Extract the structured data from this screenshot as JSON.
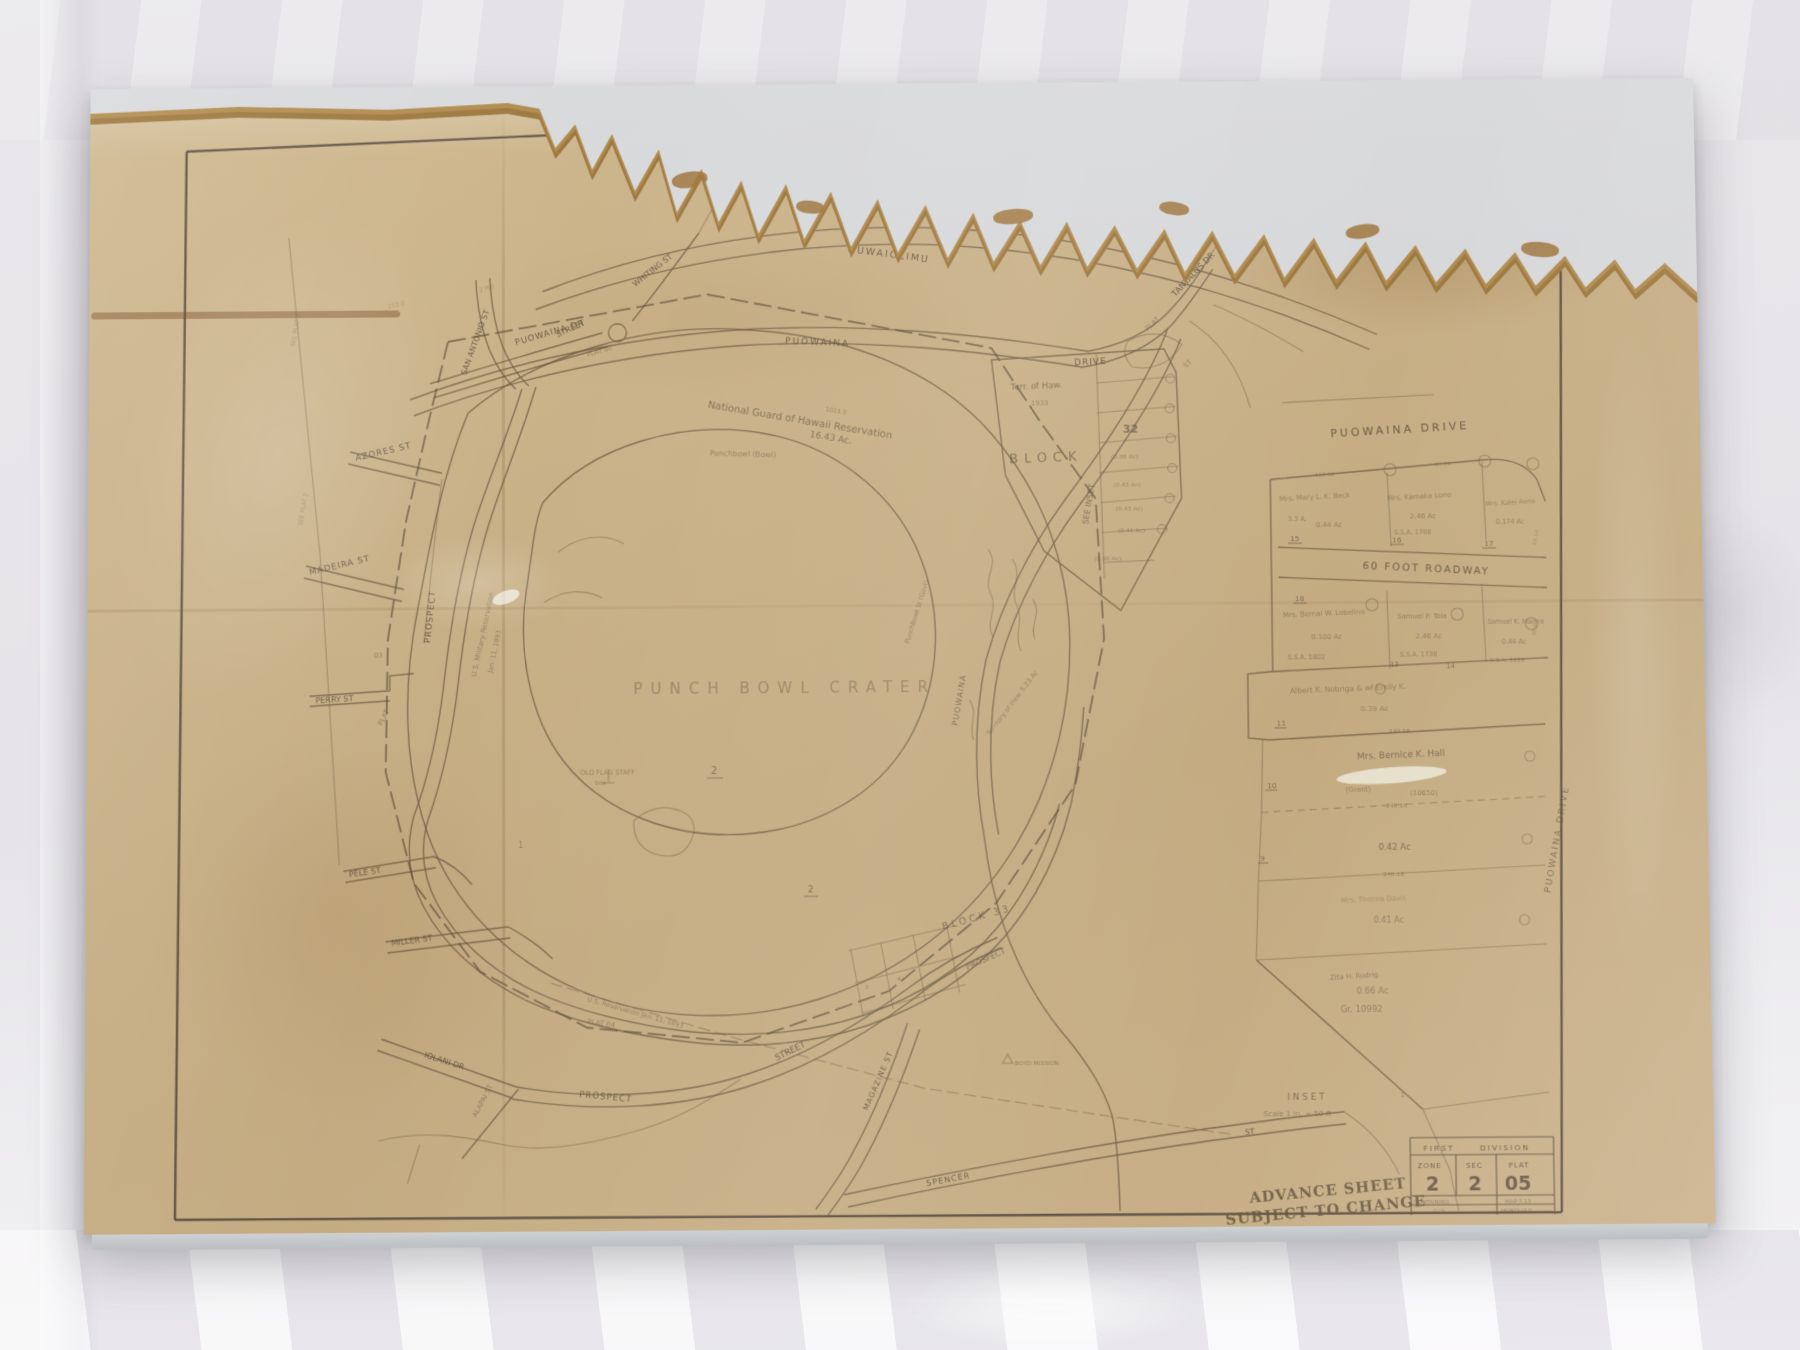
{
  "colors": {
    "paper": "#c9b188",
    "paper_torn_edge": "#9d7940",
    "ink": "#57483a",
    "sleeve_backing": "#d6d7d9",
    "fabric": "#e9e7ea",
    "stamp_ink": "#66563f"
  },
  "map": {
    "streets": {
      "auwaiolimu": "AUWAIOLIMU",
      "whiting": "WHITING ST",
      "puowaina_dr": "PUOWAINA DR",
      "street_upper": "STREET",
      "plat06": "PLAT 06",
      "puowaina": "PUOWAINA",
      "drive": "DRIVE",
      "plat07": "PLAT",
      "tantalus_st": "ST",
      "tantalus": "TANTALUS DR",
      "san_antonio": "SAN ANTONIO ST",
      "azores": "AZORES ST",
      "madeira": "MADEIRA ST",
      "prospect_west": "PROSPECT",
      "perry": "PERRY ST",
      "plat03": "PLAT",
      "plat03_num": "03",
      "pele": "PELE ST",
      "miller": "MILLER ST",
      "iolani": "IOLANI DR",
      "alapai": "ALAPAI ST",
      "prospect_south": "PROSPECT",
      "street_south": "STREET",
      "prospect_east": "PROSPECT",
      "plat04": "PLAT 04",
      "magazine": "MAGAZINE ST",
      "spencer": "SPENCER",
      "spencer_st2": "ST",
      "puowaina_east": "PUOWAINA"
    },
    "labels": {
      "crater": "PUNCH BOWL CRATER",
      "ng1": "National Guard of Hawaii Reservation",
      "ng2": "16.43 Ac.",
      "meas1": "1023.9",
      "punchbowl_bowl": "Punchbowl (Bowl)",
      "usmil1": "U.S. Military Reservation",
      "usmil2": "Jan. 11, 1893",
      "usres": "U.S. Reservation  Jan. 11, 1893",
      "terr1": "Terr. of Haw.",
      "terr2": "1933",
      "block": "BLOCK",
      "block32": "32",
      "see_inset": "SEE INSET",
      "block33": "BLOCK 33",
      "flag1": "OLD FLAG STAFF",
      "flag2": "Site",
      "n1": "1",
      "n2": "2",
      "n2b": "2",
      "n3": "3",
      "n4": "4",
      "boyd": "BOYD MISSION",
      "punchbowl_st": "Punchbowl St (Govt)",
      "territory": "Territory of Haw.  5.23 Ac",
      "ac1": "(0.38 Ac)",
      "ac2": "(0.43 Ac)",
      "ac3": "(0.43 Ac)",
      "ac4": "(0.41 Ac)",
      "ac5": "(0.90 Ac)",
      "see_plat_l1": "SEE PLAT 2",
      "see_plat_l2": "SEE PLAT 2",
      "meas2": "2760",
      "meas3": "212.0"
    }
  },
  "inset": {
    "header": "PUOWAINA DRIVE",
    "roadway": "60 FOOT ROADWAY",
    "drive_vertical": "PUOWAINA  DRIVE",
    "inset_l1": "INSET",
    "inset_l2": "Scale 1 in. = 50 ft",
    "p15": {
      "num": "15",
      "name": "Mrs. Mary L. K. Beck",
      "l2": "3.3 A.",
      "l3": "0.44 Ac"
    },
    "p16": {
      "num": "16",
      "name": "Mrs. Kamaka Lono",
      "l2": "2.46 Ac",
      "l3": "S.S.A. 1788"
    },
    "p17": {
      "num": "17",
      "name": "Mrs. Kalei Aona",
      "l2": "0.174 Ac"
    },
    "p18": {
      "num": "18",
      "name": "Mrs. Bernal W. Lobelino",
      "l2": "0.100 Ac",
      "l3": "S.S.A. 1802"
    },
    "p13": {
      "num": "13",
      "name": "Samuel P. Tola",
      "l2": "2.46 Ac",
      "l3": "S.S.A. 1738"
    },
    "p14": {
      "num": "14",
      "name": "Samuel K. Mamia",
      "l2": "0.44 Ac",
      "l3": "S.S.A. 1139"
    },
    "p11": {
      "num": "11",
      "name": "Albert K. Nobriga & wf Emily K.",
      "l2": "0.39 Ac",
      "meas": "240.18"
    },
    "p10": {
      "num": "10",
      "name": "Mrs. Bernice K. Hall",
      "l2": "(Grant)",
      "l3": "(10650)",
      "meas": "240.18"
    },
    "p9": {
      "num": "9",
      "l2": "0.42 Ac",
      "meas": "240.18"
    },
    "p8": {
      "name": "Mrs. Thelma Davis",
      "l2": "0.41 Ac"
    },
    "tri": {
      "name": "Zita H. Rodrig.",
      "l2": "0.66 Ac",
      "l3": "Gr. 10992",
      "n": "1"
    },
    "meas_a": "122.18",
    "meas_b": "87.64",
    "meas_c": "66.14",
    "meas_d": "98.6"
  },
  "title_block": {
    "div1": "FIRST",
    "div2": "DIVISION",
    "zone_h": "ZONE",
    "sec_h": "SEC",
    "plat_h": "PLAT",
    "zone_v": "2",
    "sec_v": "2",
    "plat_v": "05",
    "containing": "CONTAINING",
    "map_t": "MAP 7.13",
    "row5a": "ALIN",
    "row5b": "HONOLULU",
    "printed": "PRINTED"
  },
  "stamp": {
    "line1": "ADVANCE SHEET",
    "line2": "SUBJECT TO CHANGE"
  }
}
